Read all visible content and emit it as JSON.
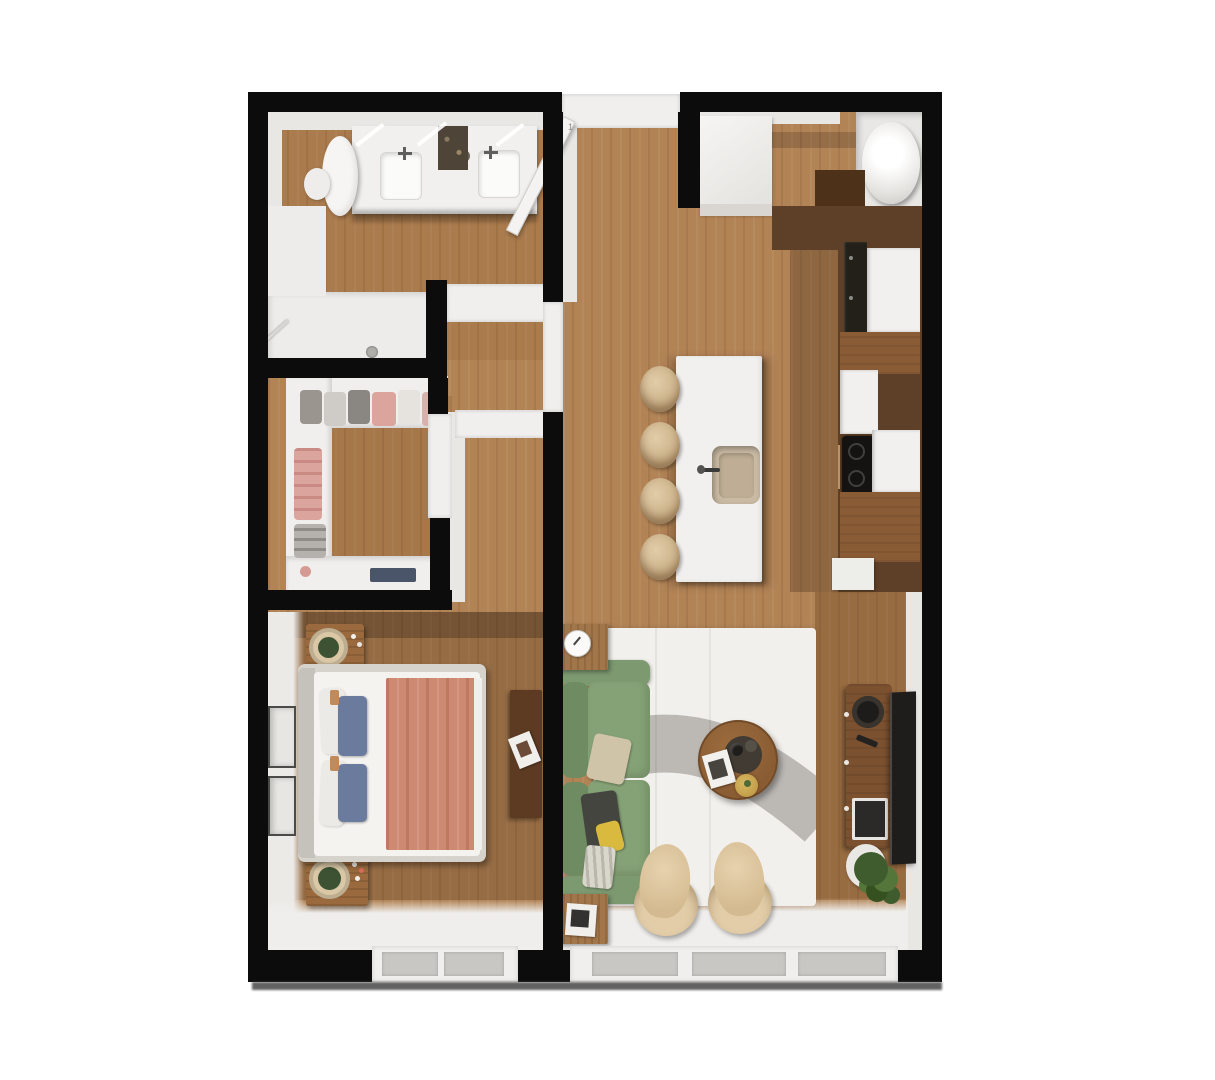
{
  "meta": {
    "type": "3d-floor-plan-render",
    "description": "Top-down 3D architectural render of a one-bedroom apartment: bathroom and walk-in closet on the upper left, entry hall and kitchen with island on the right, bedroom lower left, living room lower right"
  },
  "labels": {
    "door_marker": "1"
  },
  "rooms": [
    "bathroom",
    "walk-in-closet",
    "entry-hall",
    "kitchen",
    "bedroom",
    "living-room"
  ],
  "furniture": {
    "bathroom": [
      "toilet",
      "double-vanity",
      "sink",
      "shower",
      "shower-drain",
      "glass-partition"
    ],
    "closet": [
      "wardrobe-shelves",
      "hanging-clothes"
    ],
    "kitchen": [
      "island-with-sink",
      "bar-stools",
      "cooktop",
      "oven",
      "fridge-cabinet",
      "water-heater",
      "entry-cabinet"
    ],
    "bedroom": [
      "double-bed",
      "blue-pillows",
      "salmon-blanket",
      "nightstands",
      "lamps",
      "wall-frames",
      "dresser"
    ],
    "living": [
      "green-sofa",
      "side-tables",
      "clock",
      "round-coffee-table",
      "armchairs",
      "tv-console",
      "tv",
      "plant",
      "rug"
    ]
  },
  "colors": {
    "wall": "#0c0c0c",
    "wallShadow": "#474747",
    "face": "#e9e7e4",
    "jamb": "#f0efed",
    "floorWood": "#b28355",
    "bathTint": "rgba(140,95,50,0.22)",
    "bedTint": "rgba(70,42,20,0.26)",
    "closetTint": "rgba(120,78,32,0.22)",
    "whiteBlock": "#f1f0ee",
    "counterDark": "#5e3f27",
    "counterDarker": "#4e3119",
    "counterWood": "#8a5c36",
    "appliance": "#222018",
    "cooktop": "#141312",
    "glass": "#c9c7c4",
    "rug": "#f2f0ec",
    "rugGray": "#b7b4b0",
    "sofa": "#85a276",
    "sofaDark": "#6f8b62",
    "sofaArm": "#7d9970",
    "blanket": "#cd8971",
    "blanketFold": "#f0efec",
    "pillowBlue": "#6b7b9e",
    "mattress": "#f4f3f0",
    "bedFrame": "#d6d3cd",
    "furnWood": "#9a6a3e",
    "tableWood": "#a3764a",
    "coffeeWood": "#8a5c33",
    "tvConsole": "#7c5130",
    "tvBlack": "#1f1d1c",
    "stool": "#c6ab82",
    "stoolHi": "#e2cda9",
    "lampRing": "#d9c7a6",
    "lampGreen": "#3d5233",
    "plant": "#3f5c2e",
    "plantHi": "#55763a",
    "sinkBasin": "#c9baa3",
    "clothesPink": "#dba49c",
    "clothesGray": "#b5b1ac",
    "accentYellow": "#d9ba3e",
    "pillowDark": "#454540",
    "pillowBeige": "#cfc3a8"
  }
}
